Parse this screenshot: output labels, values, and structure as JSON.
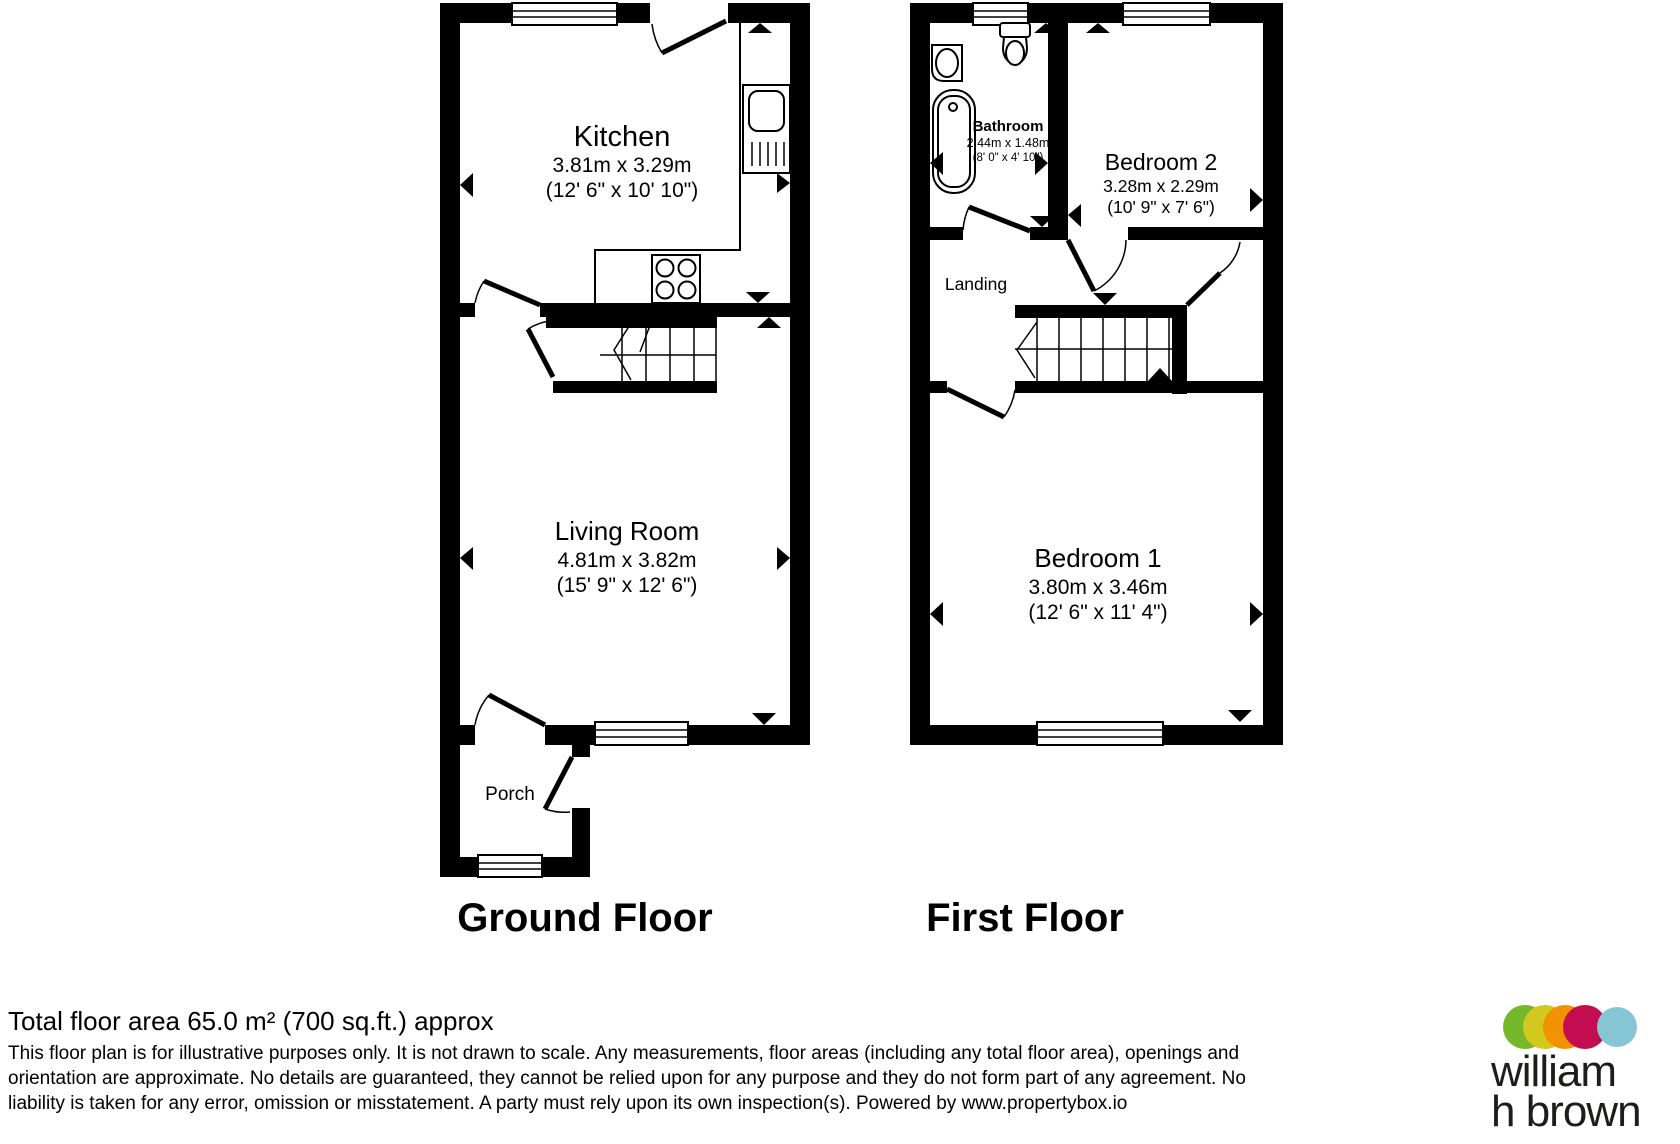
{
  "ground_floor": {
    "title": "Ground Floor",
    "rooms": {
      "kitchen": {
        "name": "Kitchen",
        "size_metric": "3.81m x 3.29m",
        "size_imperial": "(12' 6\" x 10' 10\")"
      },
      "living_room": {
        "name": "Living Room",
        "size_metric": "4.81m x 3.82m",
        "size_imperial": "(15' 9\" x 12' 6\")"
      },
      "porch": {
        "name": "Porch"
      }
    }
  },
  "first_floor": {
    "title": "First Floor",
    "rooms": {
      "bathroom": {
        "name": "Bathroom",
        "size_metric": "2.44m x 1.48m",
        "size_imperial": "(8' 0\" x 4' 10\")"
      },
      "bedroom_2": {
        "name": "Bedroom 2",
        "size_metric": "3.28m x 2.29m",
        "size_imperial": "(10' 9\" x 7' 6\")"
      },
      "landing": {
        "name": "Landing"
      },
      "bedroom_1": {
        "name": "Bedroom 1",
        "size_metric": "3.80m x 3.46m",
        "size_imperial": "(12' 6\" x 11' 4\")"
      }
    }
  },
  "footer": {
    "total_area": "Total floor area 65.0 m² (700 sq.ft.) approx",
    "disclaimer_line1": "This floor plan is for illustrative purposes only. It is not drawn to scale. Any measurements, floor areas (including any total floor area), openings and",
    "disclaimer_line2": "orientation are approximate. No details are guaranteed, they cannot be relied upon for any purpose and they do not form part of any agreement. No",
    "disclaimer_line3": "liability is taken for any error, omission or misstatement. A party must rely upon its own inspection(s). Powered by www.propertybox.io"
  },
  "logo": {
    "name_line1": "william",
    "name_line2": "h brown",
    "dot_colors": {
      "green": "#76b82a",
      "yellow": "#d3c81e",
      "orange": "#f39200",
      "crimson": "#c40d50",
      "blue": "#86c5d4"
    },
    "text_color": "#1d1d1b"
  }
}
